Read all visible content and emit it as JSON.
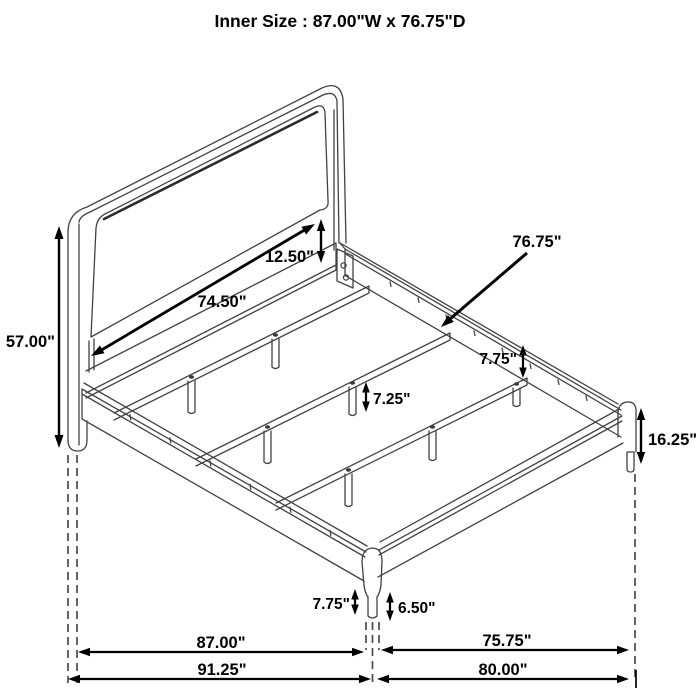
{
  "title": "Inner Size : 87.00\"W x 76.75\"D",
  "diagram": {
    "subject": "bed frame isometric dimension drawing",
    "background": "#ffffff",
    "line_color": "#424242",
    "dimension_color": "#000000",
    "labels": {
      "headboard_inner_width": "74.50\"",
      "headboard_panel_gap": "12.50\"",
      "headboard_height": "57.00\"",
      "inner_depth": "76.75\"",
      "side_rail_height": "7.75\"",
      "center_support_leg_height": "7.25\"",
      "corner_leg_height": "16.25\"",
      "front_leg_height": "7.75\"",
      "front_leg_lower_height": "6.50\"",
      "inner_width": "87.00\"",
      "overall_width": "91.25\"",
      "inner_depth_floor": "75.75\"",
      "overall_depth": "80.00\""
    }
  }
}
